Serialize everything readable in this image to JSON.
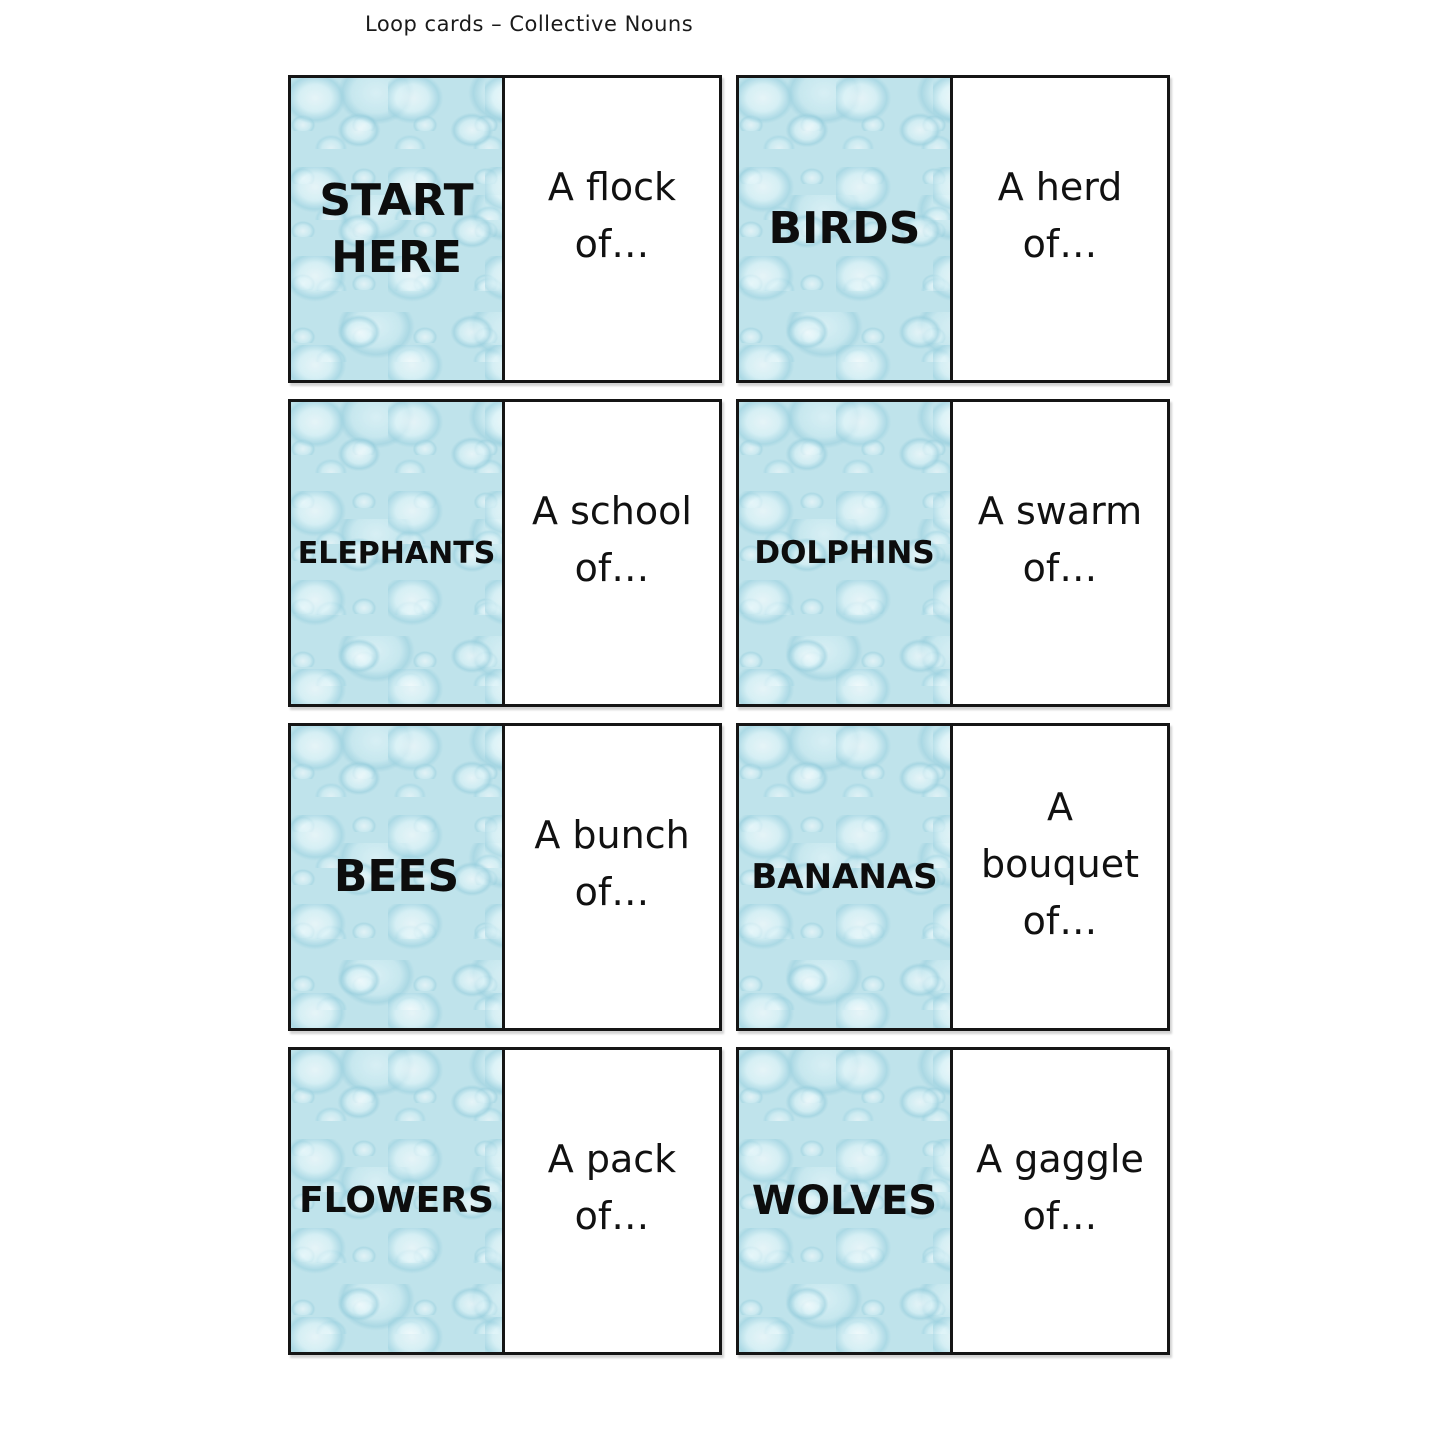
{
  "page": {
    "title": "Loop cards – Collective Nouns"
  },
  "cards": [
    {
      "term": "START\nHERE",
      "clue": "A flock\nof…"
    },
    {
      "term": "BIRDS",
      "clue": "A herd\nof…"
    },
    {
      "term": "ELEPHANTS",
      "clue": "A school\nof…"
    },
    {
      "term": "DOLPHINS",
      "clue": "A swarm\nof…"
    },
    {
      "term": "BEES",
      "clue": "A bunch\nof…"
    },
    {
      "term": "BANANAS",
      "clue": "A\nbouquet\nof…"
    },
    {
      "term": "FLOWERS",
      "clue": "A pack\nof…"
    },
    {
      "term": "WOLVES",
      "clue": "A gaggle\nof…"
    }
  ],
  "colors": {
    "card_border": "#151515",
    "texture_base": "#bfe3eb",
    "texture_highlight": "#eefbfd",
    "texture_shadow": "#9ed2e0",
    "text": "#0d0d0d",
    "page_background": "#ffffff"
  }
}
